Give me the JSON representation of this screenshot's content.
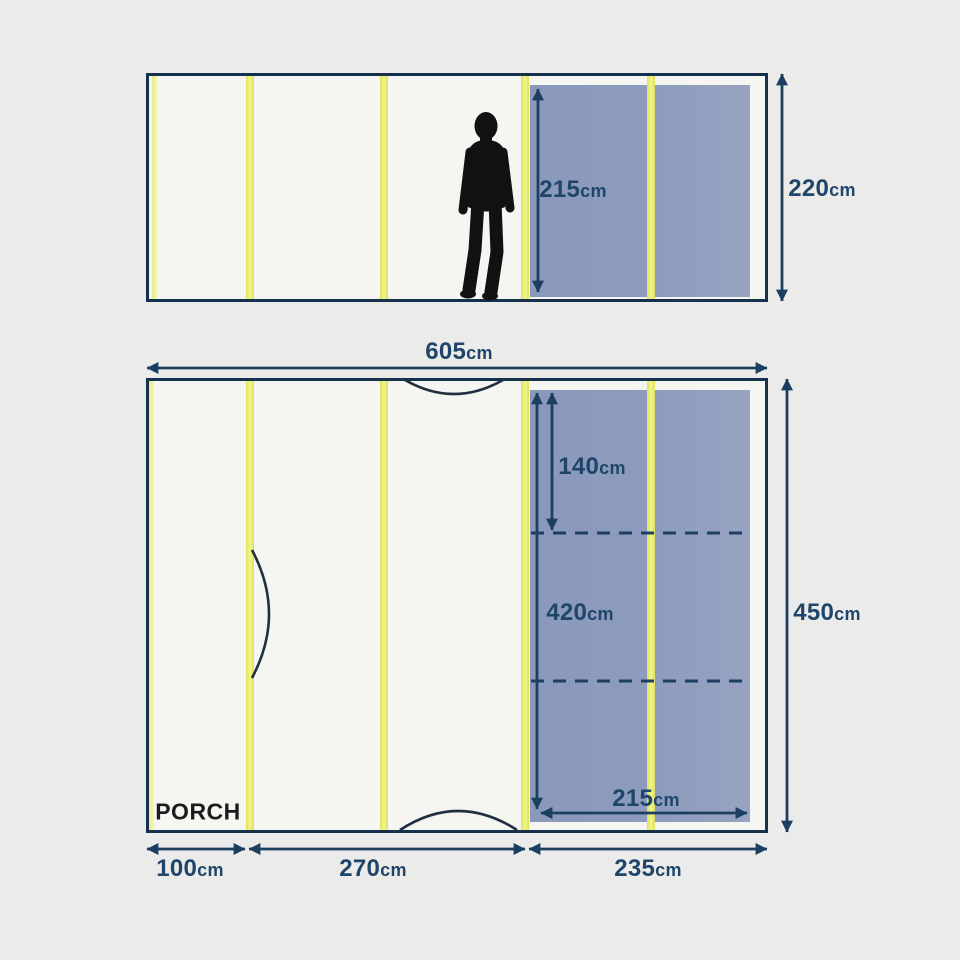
{
  "colors": {
    "background": "#ebecea",
    "outline_navy": "#16314d",
    "dimension_navy": "#1c3e60",
    "text_navy": "#20456b",
    "pole_yellow": "#e8eb6d",
    "sleeping_area_blue": "#8d9bbd",
    "panel_white": "#f5f6f2",
    "figure_black": "#111111",
    "porch_text": "#1b1b1b"
  },
  "side_view": {
    "inner_height": {
      "value": "215",
      "unit": "cm"
    },
    "total_height": {
      "value": "220",
      "unit": "cm"
    }
  },
  "floor_plan": {
    "total_width": {
      "value": "605",
      "unit": "cm"
    },
    "sleeping_area": {
      "front_depth": {
        "value": "140",
        "unit": "cm"
      },
      "length": {
        "value": "420",
        "unit": "cm"
      },
      "width": {
        "value": "215",
        "unit": "cm"
      }
    },
    "total_depth": {
      "value": "450",
      "unit": "cm"
    },
    "porch_label": "PORCH",
    "bottom_sections": [
      {
        "value": "100",
        "unit": "cm"
      },
      {
        "value": "270",
        "unit": "cm"
      },
      {
        "value": "235",
        "unit": "cm"
      }
    ]
  }
}
